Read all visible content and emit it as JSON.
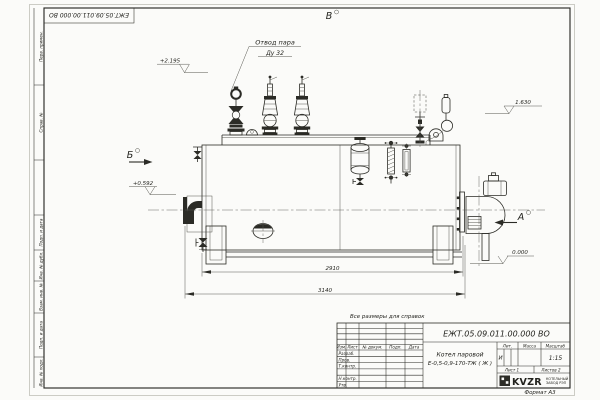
{
  "page": {
    "note": "Все размеры для справок",
    "format": "Формат А3"
  },
  "stamp": {
    "number": "ЕЖТ.05.09.011.00.000  ВО"
  },
  "margin_labels": {
    "top": [
      "Перв. примен.",
      "Справ. №"
    ],
    "bottom": [
      "Подп. и дата",
      "Инв. № дубл.",
      "Взам. инв. №",
      "Подп. и дата",
      "Инв. № подл."
    ]
  },
  "views": {
    "a": "А",
    "b": "Б",
    "v": "В"
  },
  "callouts": {
    "steam_line1": "Отвод пара",
    "steam_line2": "Ду 32"
  },
  "elevations": {
    "top": "+2.195",
    "gauge": "1.630",
    "axis": "+0.592",
    "ground": "0.000"
  },
  "dimensions": {
    "shell_length": "2910",
    "overall_length": "3140"
  },
  "title_block": {
    "number": "ЕЖТ.05.09.011.00.000  ВО",
    "name1": "Котел паровой",
    "name2": "Е-0,5-0,9-170-ТЖ ( Ж )",
    "cols": [
      "Изм.",
      "Лист",
      "№ докум.",
      "Подп.",
      "Дата"
    ],
    "rows": [
      "Разраб.",
      "Пров.",
      "Т.контр.",
      "",
      "Н.контр.",
      "Утв."
    ],
    "lit_label": "Лит.",
    "lit_value": "И",
    "mass_label": "Масса",
    "scale_label": "Масштаб",
    "scale_value": "1:15",
    "sheet": "Лист 1",
    "sheets": "Листов 2",
    "logo": "KVZR",
    "logo_line1": "КОТЕЛЬНЫЙ",
    "logo_line2": "ЗАВОД РЭП"
  }
}
